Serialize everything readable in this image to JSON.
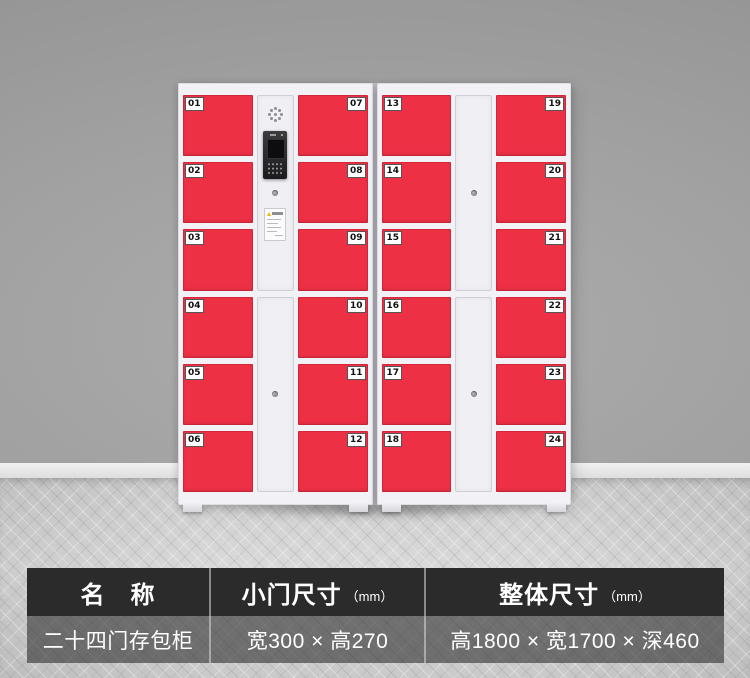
{
  "colors": {
    "door_red": "#ee3045",
    "cabinet_white": "#f2f2f6",
    "wall_gray": "#9e9e9e",
    "floor_gray": "#d3d3d3",
    "table_header_bg": "#2b2b2b",
    "table_value_bg": "#6f6f6f",
    "table_text": "#ffffff",
    "warning_yellow": "#f4b400"
  },
  "icons": {
    "keyhole": "small gray circle",
    "speaker": "ring of dots",
    "warning": "yellow triangle",
    "keypad": "grid of dots",
    "screen": "dark rectangle"
  },
  "cabinets": [
    {
      "left_doors": [
        "01",
        "02",
        "03",
        "04",
        "05",
        "06"
      ],
      "right_doors": [
        "07",
        "08",
        "09",
        "10",
        "11",
        "12"
      ]
    },
    {
      "left_doors": [
        "13",
        "14",
        "15",
        "16",
        "17",
        "18"
      ],
      "right_doors": [
        "19",
        "20",
        "21",
        "22",
        "23",
        "24"
      ]
    }
  ],
  "spec_table": {
    "columns": [
      {
        "header": "名　称",
        "unit": "",
        "value": "二十四门存包柜"
      },
      {
        "header": "小门尺寸",
        "unit": "（mm）",
        "value": "宽300 × 高270"
      },
      {
        "header": "整体尺寸",
        "unit": "（mm）",
        "value": "高1800 × 宽1700 × 深460"
      }
    ]
  }
}
